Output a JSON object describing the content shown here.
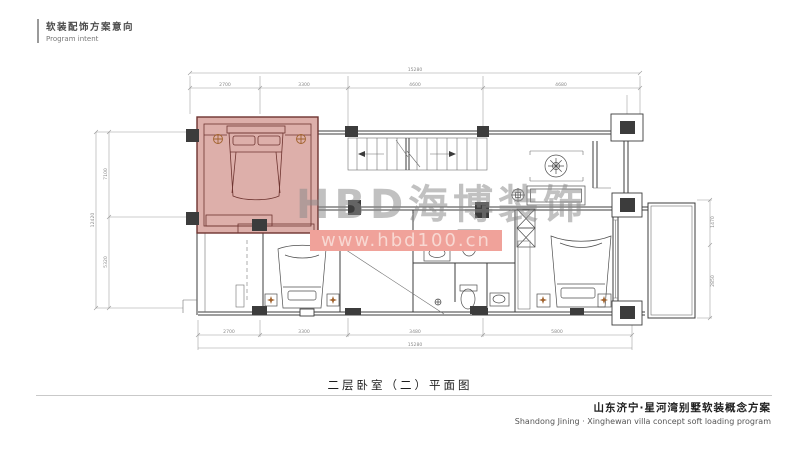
{
  "header": {
    "title_cn": "软装配饰方案意向",
    "title_en": "Program intent"
  },
  "watermark": {
    "brand": "HBD海博装饰",
    "url": "www.hbd100.cn"
  },
  "caption": {
    "text": "二层卧室（二）平面图"
  },
  "footer": {
    "line_cn": "山东济宁·星河湾别墅软装概念方案",
    "line_en": "Shandong Jining · Xinghewan villa concept soft loading program"
  },
  "colors": {
    "highlight_fill": "#d7a19b",
    "highlight_border": "#6e3430",
    "plan_line": "#3c3c3c",
    "dim_line": "#9a9a9a",
    "accent_lamp": "#a0622d",
    "watermark_text": "#8a8a8a",
    "watermark_bar": "#f0a29a",
    "watermark_url": "#f8d8d2"
  },
  "plan": {
    "dims": {
      "top": {
        "overall": "15280",
        "segments": [
          "2700",
          "3300",
          "4600",
          "4680"
        ]
      },
      "bottom": {
        "overall": "15280",
        "segments": [
          "2700",
          "3300",
          "3480",
          "5800"
        ]
      },
      "left": {
        "overall": "12420",
        "segments": [
          "7100",
          "5320"
        ]
      },
      "right": {
        "segments": [
          "1470",
          "2850"
        ]
      }
    }
  }
}
